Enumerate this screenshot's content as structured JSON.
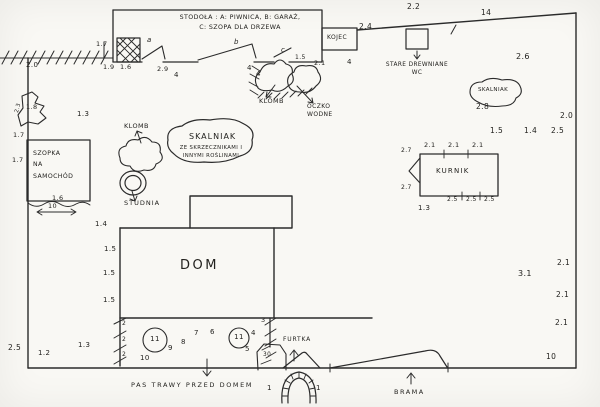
{
  "colors": {
    "ink": "#2b2b2b",
    "paper": "#f9f8f4"
  },
  "labels": [
    {
      "name": "stodola-title",
      "text": "STODOŁA : A: PIWNICA, B: GARAŻ,\nC: SZOPA DLA DRZEWA",
      "x": 160,
      "y": 13,
      "w": 160,
      "size": 6.3,
      "lh": 1.55
    },
    {
      "name": "section-letter-a",
      "text": "a",
      "x": 147,
      "y": 36,
      "size": 7,
      "cls": "script"
    },
    {
      "name": "section-letter-b",
      "text": "b",
      "x": 234,
      "y": 38,
      "size": 7,
      "cls": "script"
    },
    {
      "name": "section-letter-c",
      "text": "c",
      "x": 281,
      "y": 46,
      "size": 7,
      "cls": "script"
    },
    {
      "name": "kojec-label",
      "text": "KOJEC",
      "x": 327,
      "y": 34,
      "size": 6
    },
    {
      "name": "dim-24",
      "text": "2.4",
      "x": 359,
      "y": 22,
      "size": 7.5
    },
    {
      "name": "dim-22",
      "text": "2.2",
      "x": 407,
      "y": 2,
      "size": 7.5
    },
    {
      "name": "dim-14-top",
      "text": "14",
      "x": 481,
      "y": 8,
      "size": 7.5
    },
    {
      "name": "wc-label",
      "text": "STARE DREWNIANE\nWC",
      "x": 379,
      "y": 61,
      "w": 76,
      "size": 5.8,
      "lh": 1.4
    },
    {
      "name": "dim-26",
      "text": "2.6",
      "x": 516,
      "y": 52,
      "size": 8
    },
    {
      "name": "dim-17-top",
      "text": "1.7",
      "x": 96,
      "y": 40,
      "size": 6.5
    },
    {
      "name": "dim-19",
      "text": "1.9",
      "x": 103,
      "y": 63,
      "size": 6.5
    },
    {
      "name": "dim-16-top",
      "text": "1.6",
      "x": 120,
      "y": 63,
      "size": 6.5
    },
    {
      "name": "dim-29",
      "text": "2.9",
      "x": 157,
      "y": 65,
      "size": 6.5
    },
    {
      "name": "dim-4-a",
      "text": "4",
      "x": 174,
      "y": 71,
      "size": 7
    },
    {
      "name": "dim-4-b",
      "text": "4",
      "x": 256,
      "y": 70,
      "size": 7
    },
    {
      "name": "dim-4-c",
      "text": "4",
      "x": 247,
      "y": 64,
      "size": 7
    },
    {
      "name": "dim-15-oczko",
      "text": "1.5",
      "x": 295,
      "y": 54,
      "size": 6
    },
    {
      "name": "dim-21-oczko",
      "text": "2.1",
      "x": 314,
      "y": 59,
      "size": 6.5
    },
    {
      "name": "dim-4-d",
      "text": "4",
      "x": 347,
      "y": 58,
      "size": 7
    },
    {
      "name": "klomb-top-label",
      "text": "KLOMB",
      "x": 259,
      "y": 97,
      "size": 6.5
    },
    {
      "name": "oczko-wodne-label",
      "text": "OCZKO\nWODNE",
      "x": 307,
      "y": 103,
      "size": 6,
      "lh": 1.4
    },
    {
      "name": "dim-20-left",
      "text": "2.0",
      "x": 26,
      "y": 61,
      "size": 7
    },
    {
      "name": "dim-18",
      "text": "1.8",
      "x": 26,
      "y": 103,
      "size": 6.5
    },
    {
      "name": "dim-23",
      "text": "2.3",
      "x": 14,
      "y": 112,
      "size": 5.5,
      "rot": -75
    },
    {
      "name": "dim-13-left",
      "text": "1.3",
      "x": 77,
      "y": 110,
      "size": 7
    },
    {
      "name": "dim-17-left-a",
      "text": "1.7",
      "x": 13,
      "y": 131,
      "size": 6.5
    },
    {
      "name": "dim-17-left-b",
      "text": "1.7",
      "x": 12,
      "y": 156,
      "size": 6.5
    },
    {
      "name": "szopka-label",
      "text": "SZOPKA\nNA\nSAMOCHÓD",
      "x": 33,
      "y": 148,
      "size": 6.2,
      "lh": 1.85
    },
    {
      "name": "dim-16-szopka",
      "text": "1.6",
      "x": 52,
      "y": 194,
      "size": 6.5
    },
    {
      "name": "dim-10-szopka",
      "text": "10",
      "x": 48,
      "y": 202,
      "size": 6.5
    },
    {
      "name": "klomb-center-label",
      "text": "KLOMB",
      "x": 124,
      "y": 122,
      "size": 6.5
    },
    {
      "name": "skalniak-center-title",
      "text": "SKALNIAK",
      "x": 189,
      "y": 132,
      "size": 8,
      "ls": 1
    },
    {
      "name": "skalniak-center-sub",
      "text": "ZE SKRZECZNIKAMI I\nINNYMI ROŚLINAMI",
      "x": 176,
      "y": 145,
      "w": 70,
      "size": 5.3,
      "lh": 1.5
    },
    {
      "name": "studnia-label",
      "text": "STUDNIA",
      "x": 124,
      "y": 199,
      "size": 6.5,
      "ls": 1
    },
    {
      "name": "skalniak-right-label",
      "text": "SKALNIAK",
      "x": 478,
      "y": 87,
      "size": 5.5
    },
    {
      "name": "dim-28",
      "text": "2.8",
      "x": 476,
      "y": 102,
      "size": 7.5
    },
    {
      "name": "dim-20-right",
      "text": "2.0",
      "x": 560,
      "y": 111,
      "size": 7.5
    },
    {
      "name": "dim-15-right",
      "text": "1.5",
      "x": 490,
      "y": 126,
      "size": 7.5
    },
    {
      "name": "dim-14-right",
      "text": "1.4",
      "x": 524,
      "y": 126,
      "size": 7.5
    },
    {
      "name": "dim-25-right",
      "text": "2.5",
      "x": 551,
      "y": 126,
      "size": 7.5
    },
    {
      "name": "kurnik-label",
      "text": "KURNIK",
      "x": 436,
      "y": 167,
      "size": 7,
      "ls": 1.2
    },
    {
      "name": "dim-21-k1",
      "text": "2.1",
      "x": 424,
      "y": 141,
      "size": 6.5
    },
    {
      "name": "dim-21-k2",
      "text": "2.1",
      "x": 448,
      "y": 141,
      "size": 6.5
    },
    {
      "name": "dim-21-k3",
      "text": "2.1",
      "x": 472,
      "y": 141,
      "size": 6.5
    },
    {
      "name": "dim-27-k1",
      "text": "2.7",
      "x": 401,
      "y": 147,
      "size": 6
    },
    {
      "name": "dim-27-k2",
      "text": "2.7",
      "x": 401,
      "y": 184,
      "size": 6
    },
    {
      "name": "dim-25-k1",
      "text": "2.5",
      "x": 447,
      "y": 196,
      "size": 6
    },
    {
      "name": "dim-25-k2",
      "text": "2.5",
      "x": 466,
      "y": 196,
      "size": 6
    },
    {
      "name": "dim-25-k3",
      "text": "2.5",
      "x": 484,
      "y": 196,
      "size": 6
    },
    {
      "name": "dim-13-kurnik",
      "text": "1.3",
      "x": 418,
      "y": 204,
      "size": 7
    },
    {
      "name": "dim-31",
      "text": "3.1",
      "x": 518,
      "y": 269,
      "size": 8
    },
    {
      "name": "dim-21-r1",
      "text": "2.1",
      "x": 557,
      "y": 258,
      "size": 7.5
    },
    {
      "name": "dim-21-r2",
      "text": "2.1",
      "x": 556,
      "y": 290,
      "size": 7.5
    },
    {
      "name": "dim-21-r3",
      "text": "2.1",
      "x": 555,
      "y": 318,
      "size": 7.5
    },
    {
      "name": "dim-10-right",
      "text": "10",
      "x": 546,
      "y": 352,
      "size": 7.5
    },
    {
      "name": "dim-14-dom",
      "text": "1.4",
      "x": 95,
      "y": 220,
      "size": 7
    },
    {
      "name": "dim-15-dom1",
      "text": "1.5",
      "x": 104,
      "y": 245,
      "size": 7
    },
    {
      "name": "dim-15-dom2",
      "text": "1.5",
      "x": 103,
      "y": 269,
      "size": 7
    },
    {
      "name": "dim-15-dom3",
      "text": "1.5",
      "x": 103,
      "y": 296,
      "size": 7
    },
    {
      "name": "dom-label",
      "text": "DOM",
      "x": 180,
      "y": 257,
      "size": 13,
      "ls": 2.5
    },
    {
      "name": "dim-2-p1",
      "text": "2",
      "x": 122,
      "y": 320,
      "size": 6
    },
    {
      "name": "dim-2-p2",
      "text": "2",
      "x": 122,
      "y": 336,
      "size": 6
    },
    {
      "name": "dim-2-p3",
      "text": "2",
      "x": 122,
      "y": 351,
      "size": 6
    },
    {
      "name": "num-11-a",
      "text": "11",
      "x": 147,
      "y": 335,
      "w": 16,
      "size": 7
    },
    {
      "name": "num-9",
      "text": "9",
      "x": 168,
      "y": 344,
      "size": 7
    },
    {
      "name": "num-8",
      "text": "8",
      "x": 181,
      "y": 338,
      "size": 7
    },
    {
      "name": "num-7",
      "text": "7",
      "x": 194,
      "y": 329,
      "size": 7
    },
    {
      "name": "num-6",
      "text": "6",
      "x": 210,
      "y": 328,
      "size": 7
    },
    {
      "name": "num-11-b",
      "text": "11",
      "x": 231,
      "y": 333,
      "w": 16,
      "size": 7
    },
    {
      "name": "num-4",
      "text": "4",
      "x": 251,
      "y": 329,
      "size": 7
    },
    {
      "name": "num-5",
      "text": "5",
      "x": 245,
      "y": 345,
      "size": 7
    },
    {
      "name": "num-3",
      "text": "3",
      "x": 261,
      "y": 316,
      "size": 6.5
    },
    {
      "name": "num-10-porch",
      "text": "10",
      "x": 140,
      "y": 354,
      "size": 7
    },
    {
      "name": "num-30",
      "text": "30",
      "x": 263,
      "y": 352,
      "size": 5.8
    },
    {
      "name": "pas-trawy-label",
      "text": "PAS TRAWY PRZED DOMEM",
      "x": 131,
      "y": 381,
      "size": 6.5,
      "ls": 1.6
    },
    {
      "name": "furtka-label",
      "text": "FURTKA",
      "x": 283,
      "y": 336,
      "size": 6,
      "ls": 0.8
    },
    {
      "name": "brama-label",
      "text": "BRAMA",
      "x": 394,
      "y": 388,
      "size": 6.5,
      "ls": 1.5
    },
    {
      "name": "num-1-arch-left",
      "text": "1",
      "x": 267,
      "y": 384,
      "size": 7
    },
    {
      "name": "num-1-arch-right",
      "text": "1",
      "x": 316,
      "y": 384,
      "size": 7
    },
    {
      "name": "dim-25-bl",
      "text": "2.5",
      "x": 8,
      "y": 343,
      "size": 7.5
    },
    {
      "name": "dim-12-bl",
      "text": "1.2",
      "x": 38,
      "y": 349,
      "size": 7
    },
    {
      "name": "dim-13-bl",
      "text": "1.3",
      "x": 78,
      "y": 341,
      "size": 7
    }
  ]
}
